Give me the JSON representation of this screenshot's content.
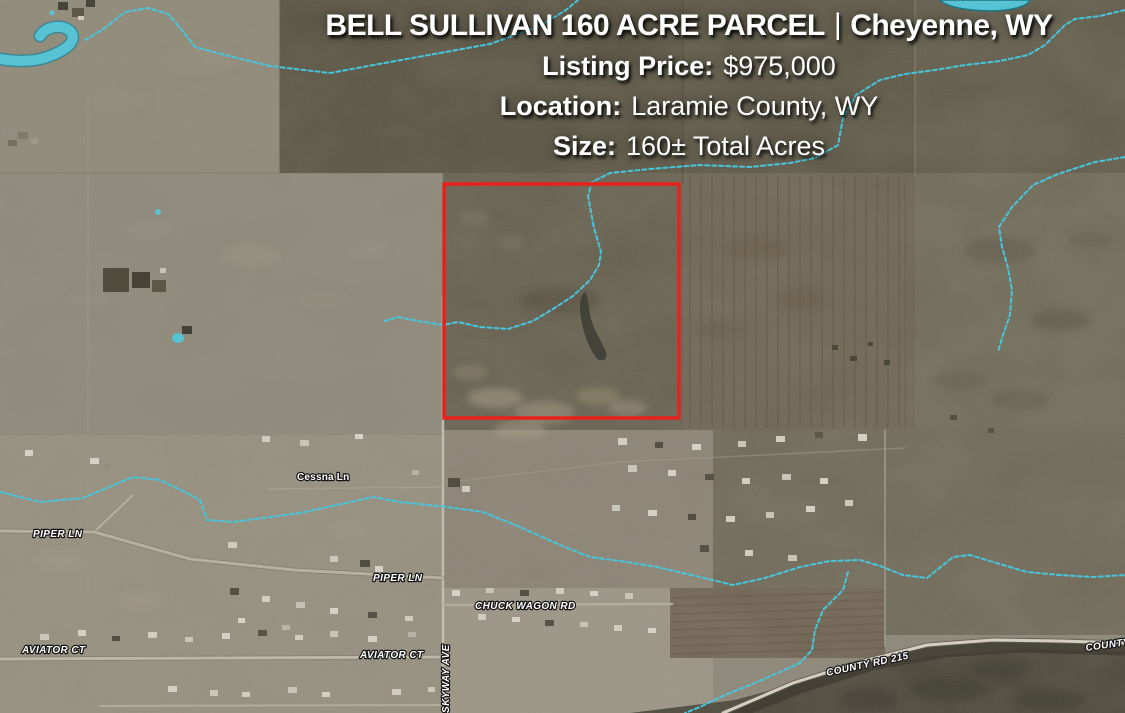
{
  "header": {
    "title": "BELL SULLIVAN 160 ACRE PARCEL",
    "separator": "|",
    "city": "Cheyenne, WY",
    "listing_price_label": "Listing Price:",
    "listing_price_value": "$975,000",
    "location_label": "Location:",
    "location_value": "Laramie County, WY",
    "size_label": "Size:",
    "size_value": "160± Total Acres"
  },
  "map": {
    "parcel": {
      "description": "Bell Sullivan 160 acre parcel boundary",
      "outline_color": "#e8221b"
    },
    "road_labels": {
      "cessna_ln": "Cessna Ln",
      "piper_ln_west": "PIPER LN",
      "piper_ln_east": "PIPER LN",
      "chuck_wagon_rd": "CHUCK WAGON RD",
      "aviator_ct_west": "AVIATOR CT",
      "aviator_ct_east": "AVIATOR CT",
      "skyway_ave": "SKYWAY AVE",
      "county_rd_215": "COUNTY RD 215",
      "county_rd_right_edge": "COUNTY R"
    },
    "colors": {
      "stream": "#3ec7e0",
      "pond": "#4fc3d6",
      "pond_outline": "#1d8196",
      "label_text": "#ffffff",
      "label_outline": "#141414"
    }
  }
}
